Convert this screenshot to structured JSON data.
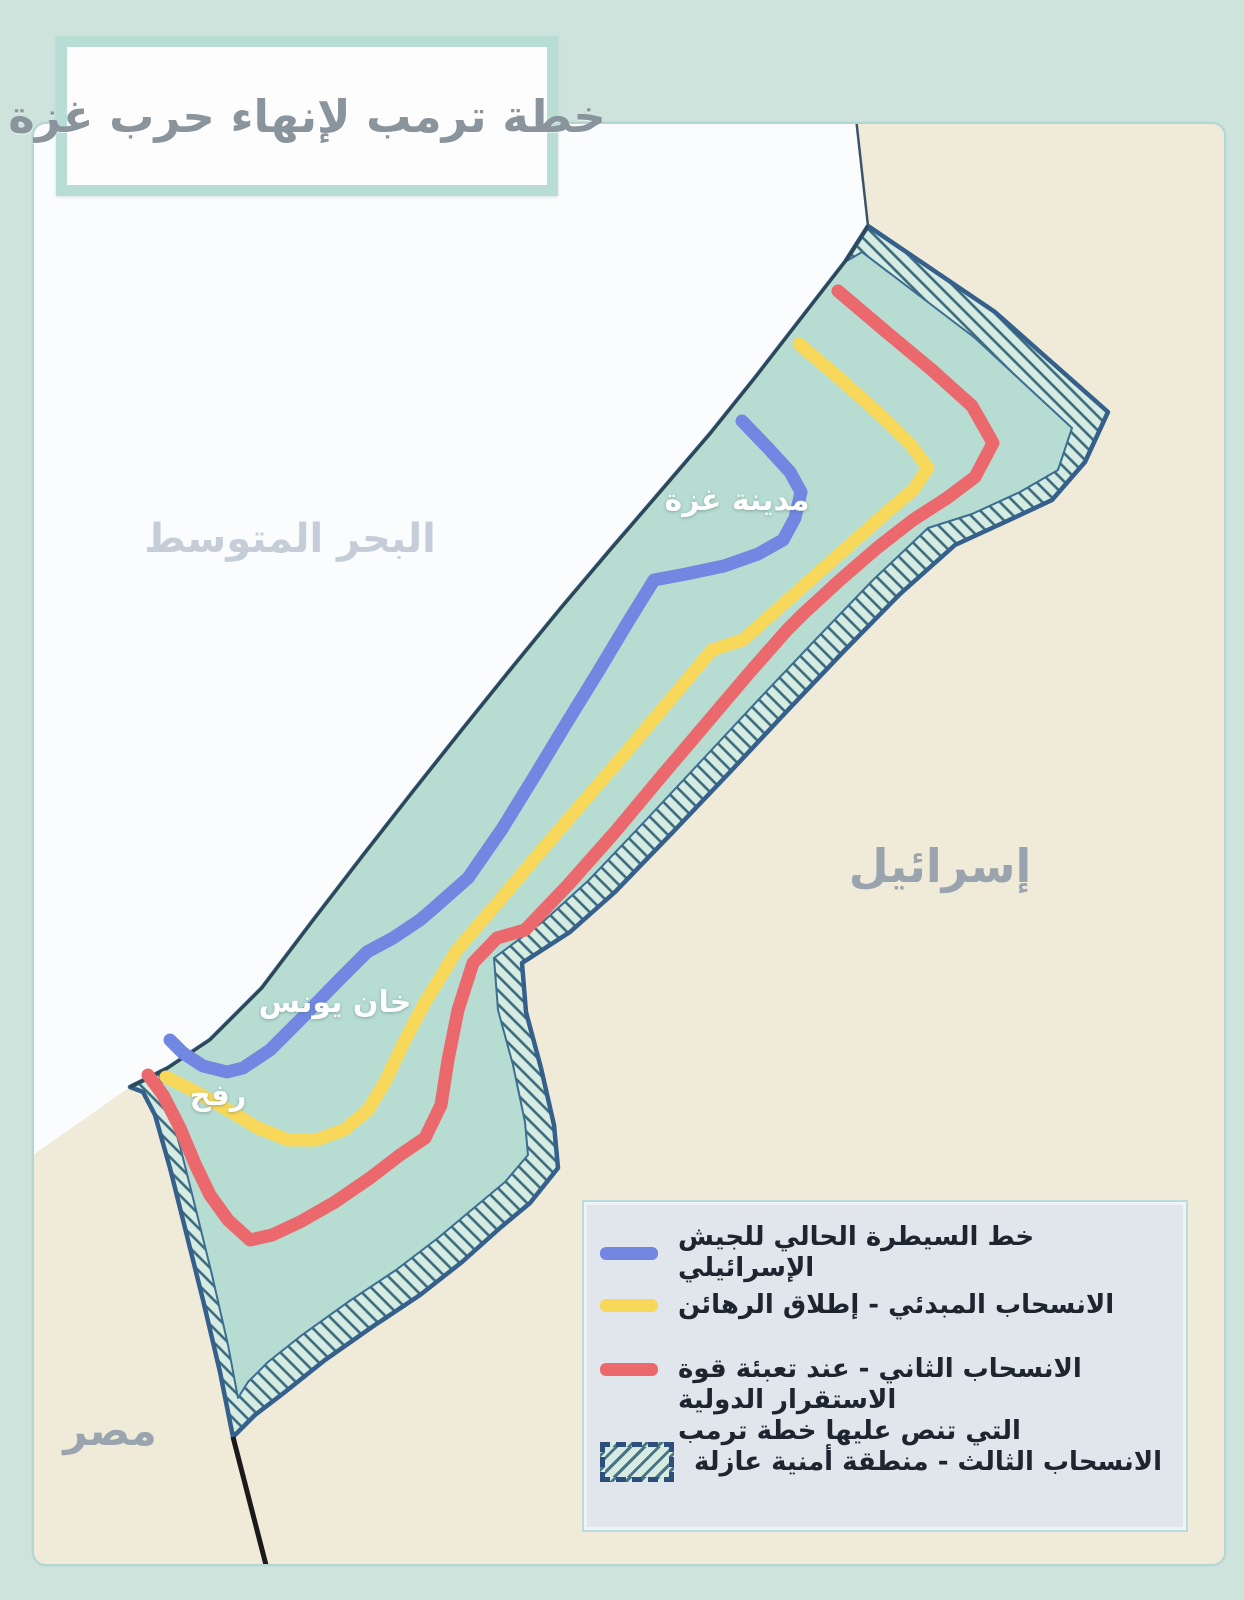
{
  "title": "خطة ترمب لإنهاء حرب غزة",
  "map_labels": {
    "sea": "البحر المتوسط",
    "gaza_city": "مدينة غزة",
    "khan_younis": "خان يونس",
    "rafah": "رفح",
    "israel": "إسرائيل",
    "egypt": "مصر"
  },
  "legend": {
    "items": [
      {
        "label": "خط السيطرة الحالي للجيش الإسرائيلي",
        "swatch": "blue-line",
        "color": "#7287e1"
      },
      {
        "label": "الانسحاب المبدئي - إطلاق الرهائن",
        "swatch": "yellow-line",
        "color": "#f8d85a"
      },
      {
        "label": "الانسحاب الثاني - عند تعبئة قوة الاستقرار الدولية",
        "label_line2": "التي تنص عليها خطة ترمب",
        "swatch": "red-line",
        "color": "#eb696c"
      },
      {
        "label": "الانسحاب الثالث - منطقة أمنية عازلة",
        "swatch": "hatched-area",
        "color": "#d6ece2"
      }
    ]
  },
  "colors": {
    "page_bg": "#cfe3dd",
    "sea": "#fbfcfd",
    "land_beige": "#f0ead8",
    "strip_fill": "#b7dcd2",
    "buffer_fill": "#d6ece2",
    "buffer_hatch": "#3a6a7c",
    "border_navy": "#35608c",
    "line_blue": "#7287e1",
    "line_yellow": "#f8d85a",
    "line_red": "#eb696c",
    "egypt_israel_border": "#1a1a1a",
    "legend_bg": "#e1e6ec",
    "title_color": "#8a949d",
    "sea_label_color": "#c5ced8",
    "neighbor_label_color": "#9aa4ae"
  }
}
